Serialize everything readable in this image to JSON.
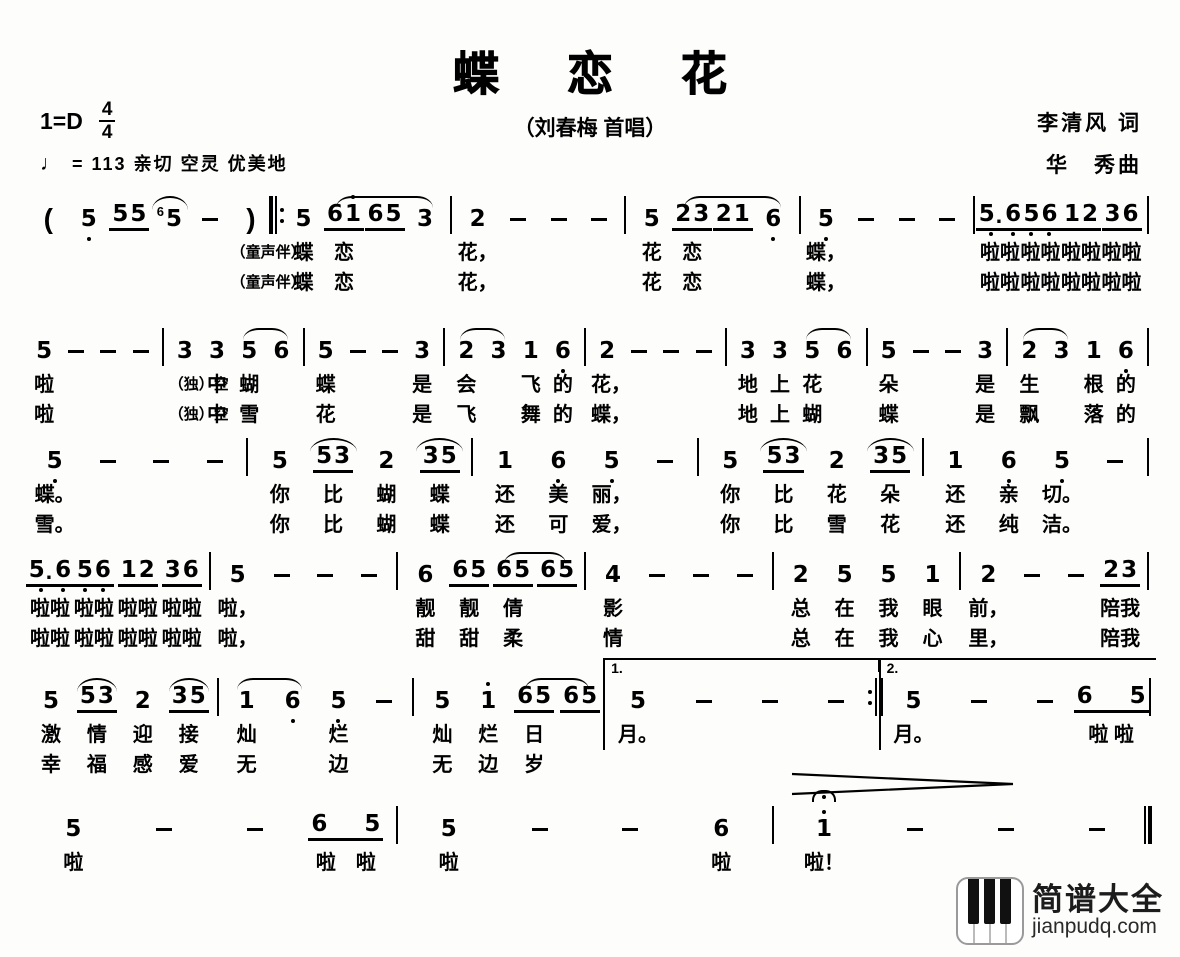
{
  "header": {
    "title": "蝶 恋 花",
    "subtitle": "（刘春梅 首唱）",
    "key": "1=D",
    "meter_top": "4",
    "meter_bottom": "4",
    "tempo_note": "♩",
    "tempo_text": "= 113  亲切 空灵 优美地",
    "lyricist": "李清风 词",
    "composer": "华　秀曲"
  },
  "watermark": {
    "icon": "piano-keys-icon",
    "site_name": "简谱大全",
    "site_url": "jianpudq.com"
  },
  "lines": [
    {
      "rows": 2,
      "cols": [
        {
          "p": "("
        },
        {
          "n": "5,"
        },
        {
          "n": "55",
          "u": 1
        },
        {
          "g": "6",
          "n": "5",
          "s": "f"
        },
        {
          "n": "-"
        },
        {
          "p": ")",
          "l1": "（童声伴）",
          "l2": "（童声伴）"
        },
        {
          "b": "rb"
        },
        {
          "n": "5",
          "l1": "蝶",
          "l2": "蝶"
        },
        {
          "n": "61'",
          "u": 1,
          "s": "s",
          "l1": "恋",
          "l2": "恋"
        },
        {
          "n": "65",
          "u": 1,
          "s": "m"
        },
        {
          "n": "3",
          "s": "e"
        },
        {
          "b": "|"
        },
        {
          "n": "2",
          "l1": "花，",
          "l2": "花，"
        },
        {
          "n": "-"
        },
        {
          "n": "-"
        },
        {
          "n": "-"
        },
        {
          "b": "|"
        },
        {
          "n": "5",
          "l1": "花",
          "l2": "花"
        },
        {
          "n": "23",
          "u": 1,
          "s": "s",
          "l1": "恋",
          "l2": "恋"
        },
        {
          "n": "21",
          "u": 1,
          "s": "m"
        },
        {
          "n": "6,",
          "s": "e"
        },
        {
          "b": "|"
        },
        {
          "n": "5,",
          "l1": "蝶，",
          "l2": "蝶，"
        },
        {
          "n": "-"
        },
        {
          "n": "-"
        },
        {
          "n": "-"
        },
        {
          "b": "|"
        },
        {
          "n": "5,.6,",
          "u": 1,
          "l1": "啦啦",
          "l2": "啦啦"
        },
        {
          "n": "5,6,",
          "u": 1,
          "l1": "啦啦",
          "l2": "啦啦"
        },
        {
          "n": "12",
          "u": 1,
          "l1": "啦啦",
          "l2": "啦啦"
        },
        {
          "n": "36",
          "u": 1,
          "l1": "啦啦",
          "l2": "啦啦"
        },
        {
          "b": "|"
        }
      ]
    },
    {
      "rows": 2,
      "cols": [
        {
          "n": "5",
          "l1": "啦",
          "l2": "啦"
        },
        {
          "n": "-"
        },
        {
          "n": "-"
        },
        {
          "n": "-"
        },
        {
          "b": "|"
        },
        {
          "n": "3",
          "l1": "（独）空",
          "l2": "（独）空"
        },
        {
          "n": "3",
          "l1": "中",
          "l2": "中"
        },
        {
          "n": "5",
          "s": "s",
          "l1": "蝴",
          "l2": "雪"
        },
        {
          "n": "6",
          "s": "e"
        },
        {
          "b": "|"
        },
        {
          "n": "5",
          "l1": "蝶",
          "l2": "花"
        },
        {
          "n": "-"
        },
        {
          "n": "-"
        },
        {
          "n": "3",
          "l1": "是",
          "l2": "是"
        },
        {
          "b": "|"
        },
        {
          "n": "2",
          "s": "s",
          "l1": "会",
          "l2": "飞"
        },
        {
          "n": "3",
          "s": "e"
        },
        {
          "n": "1",
          "l1": "飞",
          "l2": "舞"
        },
        {
          "n": "6,",
          "l1": "的",
          "l2": "的"
        },
        {
          "b": "|"
        },
        {
          "n": "2",
          "l1": "花，",
          "l2": "蝶，"
        },
        {
          "n": "-"
        },
        {
          "n": "-"
        },
        {
          "n": "-"
        },
        {
          "b": "|"
        },
        {
          "n": "3",
          "l1": "地",
          "l2": "地"
        },
        {
          "n": "3",
          "l1": "上",
          "l2": "上"
        },
        {
          "n": "5",
          "s": "s",
          "l1": "花",
          "l2": "蝴"
        },
        {
          "n": "6",
          "s": "e"
        },
        {
          "b": "|"
        },
        {
          "n": "5",
          "l1": "朵",
          "l2": "蝶"
        },
        {
          "n": "-"
        },
        {
          "n": "-"
        },
        {
          "n": "3",
          "l1": "是",
          "l2": "是"
        },
        {
          "b": "|"
        },
        {
          "n": "2",
          "s": "s",
          "l1": "生",
          "l2": "飘"
        },
        {
          "n": "3",
          "s": "e"
        },
        {
          "n": "1",
          "l1": "根",
          "l2": "落"
        },
        {
          "n": "6,",
          "l1": "的",
          "l2": "的"
        },
        {
          "b": "|"
        }
      ]
    },
    {
      "rows": 2,
      "cols": [
        {
          "n": "5,",
          "l1": "蝶。",
          "l2": "雪。"
        },
        {
          "n": "-"
        },
        {
          "n": "-"
        },
        {
          "n": "-"
        },
        {
          "b": "|"
        },
        {
          "n": "5",
          "l1": "你",
          "l2": "你"
        },
        {
          "n": "53",
          "u": 1,
          "s": "f",
          "l1": "比",
          "l2": "比"
        },
        {
          "n": "2",
          "l1": "蝴",
          "l2": "蝴"
        },
        {
          "n": "35",
          "u": 1,
          "s": "f",
          "l1": "蝶",
          "l2": "蝶"
        },
        {
          "b": "|"
        },
        {
          "n": "1",
          "l1": "还",
          "l2": "还"
        },
        {
          "n": "6,",
          "l1": "美",
          "l2": "可"
        },
        {
          "n": "5,",
          "l1": "丽，",
          "l2": "爱，"
        },
        {
          "n": "-"
        },
        {
          "b": "|"
        },
        {
          "n": "5",
          "l1": "你",
          "l2": "你"
        },
        {
          "n": "53",
          "u": 1,
          "s": "f",
          "l1": "比",
          "l2": "比"
        },
        {
          "n": "2",
          "l1": "花",
          "l2": "雪"
        },
        {
          "n": "35",
          "u": 1,
          "s": "f",
          "l1": "朵",
          "l2": "花"
        },
        {
          "b": "|"
        },
        {
          "n": "1",
          "l1": "还",
          "l2": "还"
        },
        {
          "n": "6,",
          "l1": "亲",
          "l2": "纯"
        },
        {
          "n": "5,",
          "l1": "切。",
          "l2": "洁。"
        },
        {
          "n": "-"
        },
        {
          "b": "|"
        }
      ]
    },
    {
      "rows": 2,
      "cols": [
        {
          "n": "5,.6,",
          "u": 1,
          "l1": "啦啦",
          "l2": "啦啦"
        },
        {
          "n": "5,6,",
          "u": 1,
          "l1": "啦啦",
          "l2": "啦啦"
        },
        {
          "n": "12",
          "u": 1,
          "l1": "啦啦",
          "l2": "啦啦"
        },
        {
          "n": "36",
          "u": 1,
          "l1": "啦啦",
          "l2": "啦啦"
        },
        {
          "b": "|"
        },
        {
          "n": "5",
          "l1": "啦，",
          "l2": "啦，"
        },
        {
          "n": "-"
        },
        {
          "n": "-"
        },
        {
          "n": "-"
        },
        {
          "b": "|"
        },
        {
          "n": "6",
          "l1": "靓",
          "l2": "甜"
        },
        {
          "n": "65",
          "u": 1,
          "l1": "靓",
          "l2": "甜"
        },
        {
          "n": "65",
          "u": 1,
          "s": "s",
          "l1": "倩",
          "l2": "柔"
        },
        {
          "n": "65",
          "u": 1,
          "s": "e"
        },
        {
          "b": "|"
        },
        {
          "n": "4",
          "l1": "影",
          "l2": "情"
        },
        {
          "n": "-"
        },
        {
          "n": "-"
        },
        {
          "n": "-"
        },
        {
          "b": "|"
        },
        {
          "n": "2",
          "l1": "总",
          "l2": "总"
        },
        {
          "n": "5",
          "l1": "在",
          "l2": "在"
        },
        {
          "n": "5",
          "l1": "我",
          "l2": "我"
        },
        {
          "n": "1",
          "l1": "眼",
          "l2": "心"
        },
        {
          "b": "|"
        },
        {
          "n": "2",
          "l1": "前，",
          "l2": "里，"
        },
        {
          "n": "-"
        },
        {
          "n": "-"
        },
        {
          "n": "23",
          "u": 1,
          "l1": "陪我",
          "l2": "陪我"
        },
        {
          "b": "|"
        }
      ]
    },
    {
      "rows": 2,
      "cols": [
        {
          "n": "5",
          "l1": "激",
          "l2": "幸"
        },
        {
          "n": "53",
          "u": 1,
          "s": "f",
          "l1": "情",
          "l2": "福"
        },
        {
          "n": "2",
          "l1": "迎",
          "l2": "感"
        },
        {
          "n": "35",
          "u": 1,
          "s": "f",
          "l1": "接",
          "l2": "爱"
        },
        {
          "b": "|"
        },
        {
          "n": "1",
          "s": "s",
          "l1": "灿",
          "l2": "无"
        },
        {
          "n": "6,",
          "s": "e"
        },
        {
          "n": "5,",
          "l1": "烂",
          "l2": "边"
        },
        {
          "n": "-"
        },
        {
          "b": "|"
        },
        {
          "n": "5",
          "l1": "灿",
          "l2": "无"
        },
        {
          "n": "1'",
          "l1": "烂",
          "l2": "边"
        },
        {
          "n": "65",
          "u": 1,
          "s": "s",
          "l1": "日",
          "l2": "岁"
        },
        {
          "n": "65",
          "u": 1,
          "s": "e"
        },
        {
          "v": "1.",
          "c": [
            {
              "n": "5",
              "l1": "月。"
            },
            {
              "n": "-"
            },
            {
              "n": "-"
            },
            {
              "n": "-"
            },
            {
              "b": "re"
            }
          ]
        },
        {
          "v": "2.",
          "c": [
            {
              "n": "5",
              "l1": "月。"
            },
            {
              "n": "-"
            },
            {
              "n": "-"
            },
            {
              "n": "65",
              "u": 1,
              "w": 1,
              "l1": "啦 啦"
            },
            {
              "b": "|"
            }
          ]
        }
      ]
    },
    {
      "rows": 1,
      "cols": [
        {
          "n": "5",
          "l1": "啦"
        },
        {
          "n": "-"
        },
        {
          "n": "-"
        },
        {
          "n": "65",
          "u": 1,
          "w": 1,
          "l1": "啦　啦"
        },
        {
          "b": "|"
        },
        {
          "n": "5",
          "l1": "啦"
        },
        {
          "n": "-"
        },
        {
          "n": "-"
        },
        {
          "n": "6",
          "l1": "啦"
        },
        {
          "b": "|"
        },
        {
          "n": "1'",
          "f": 1,
          "l1": "啦！"
        },
        {
          "n": "-"
        },
        {
          "n": "-"
        },
        {
          "n": "-"
        },
        {
          "b": "fin"
        }
      ]
    }
  ]
}
